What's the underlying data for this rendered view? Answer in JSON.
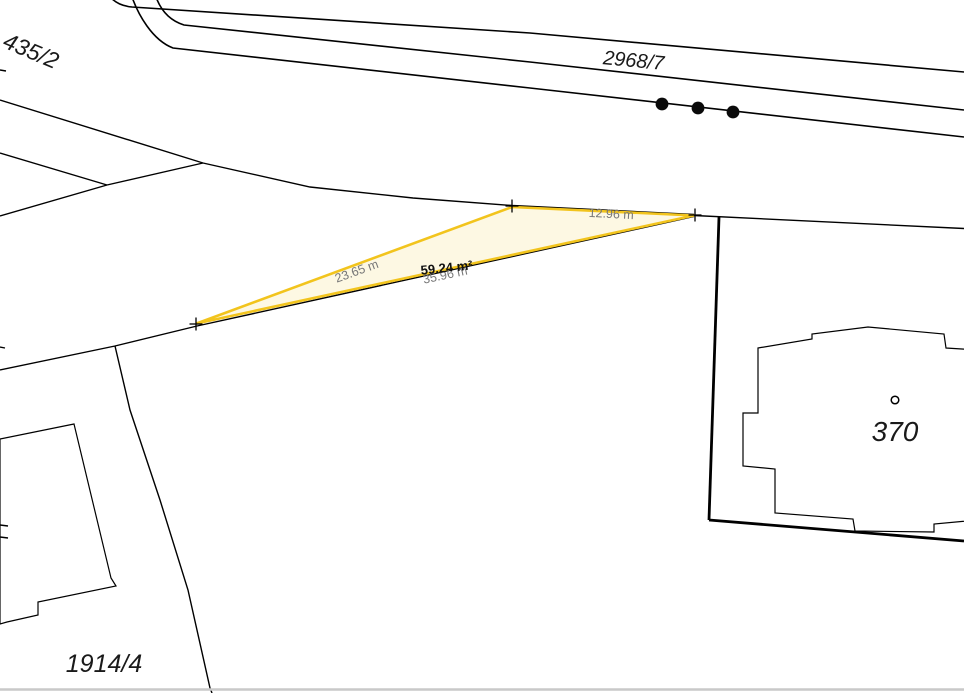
{
  "map": {
    "parcel_labels": {
      "left": "435/2",
      "road": "2968/7",
      "bottom": "1914/4",
      "building": "370"
    },
    "measurement": {
      "area": "59.24 m²",
      "edge_left": "23.65 m",
      "edge_top": "12.96 m",
      "edge_bottom": "35.96 m"
    },
    "colors": {
      "line": "#000000",
      "highlight_stroke": "#F2C41D",
      "highlight_fill": "#FDF8E3",
      "measure_text": "#777777",
      "area_text": "#111111",
      "label_text": "#1A1A1A",
      "border_gray": "#C9C9C9"
    },
    "symbols": {
      "vertex_marker": "plus-cross",
      "road_point_symbols": 3,
      "building_point_symbol": "small-circle"
    }
  }
}
